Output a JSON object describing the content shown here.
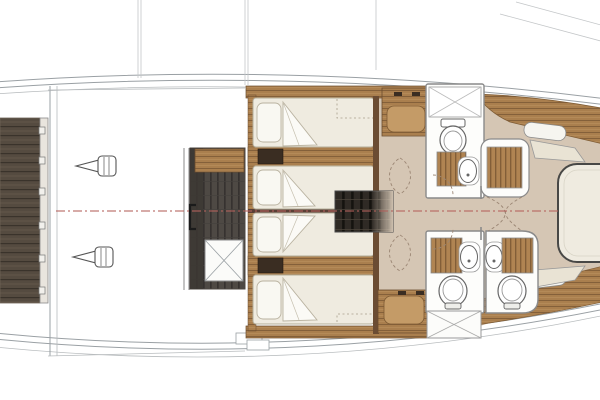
{
  "meta": {
    "title": "Yacht lower deck floor plan",
    "view": "top-down plan view, bow to the right",
    "visible_text": "none"
  },
  "colors": {
    "paper_white": "#ffffff",
    "hull_line": "#9aa0a4",
    "faint_line": "#b8bcbe",
    "floor_tan": "#d5c6b4",
    "wood_base": "#aa7f4e",
    "wood_line": "#84603a",
    "wood_panel_light": "#c49b67",
    "foot_strip_wood": "#6b4c33",
    "platform_base": "#554b40",
    "engine_floor": "#4e4944",
    "engine_floor_dark": "#3c3733",
    "stair_dark": "#2f2a25",
    "grate_base": "#b08452",
    "bed_cream": "#efebe0",
    "bed_border": "#b3ac99",
    "pillow_white": "#f9f8f2",
    "bench_cream": "#e9e3d4",
    "nightstand_dark": "#3a2d22",
    "bulkhead_brown": "#5a3f35",
    "fixture_white": "#fdfdfb",
    "fixture_stroke": "#666666",
    "wall_stroke": "#8a8a8a",
    "centerline_red": "#b5625c",
    "arc_dash": "#9b8674"
  },
  "inventory": {
    "swim_platform": 1,
    "drive_units": 2,
    "engine_room_hatches": 1,
    "guest_cabins": 2,
    "twin_beds": 4,
    "nightstands": 2,
    "staircases": 1,
    "toilets": 3,
    "sinks": 3,
    "shower_gratings": 5,
    "wardrobes_x_marked": 1,
    "storage_hatches_x_marked": 2,
    "island_beds": 1,
    "bow_benches": 2
  },
  "centerline": {
    "style": "dash-dot",
    "y": 211
  }
}
